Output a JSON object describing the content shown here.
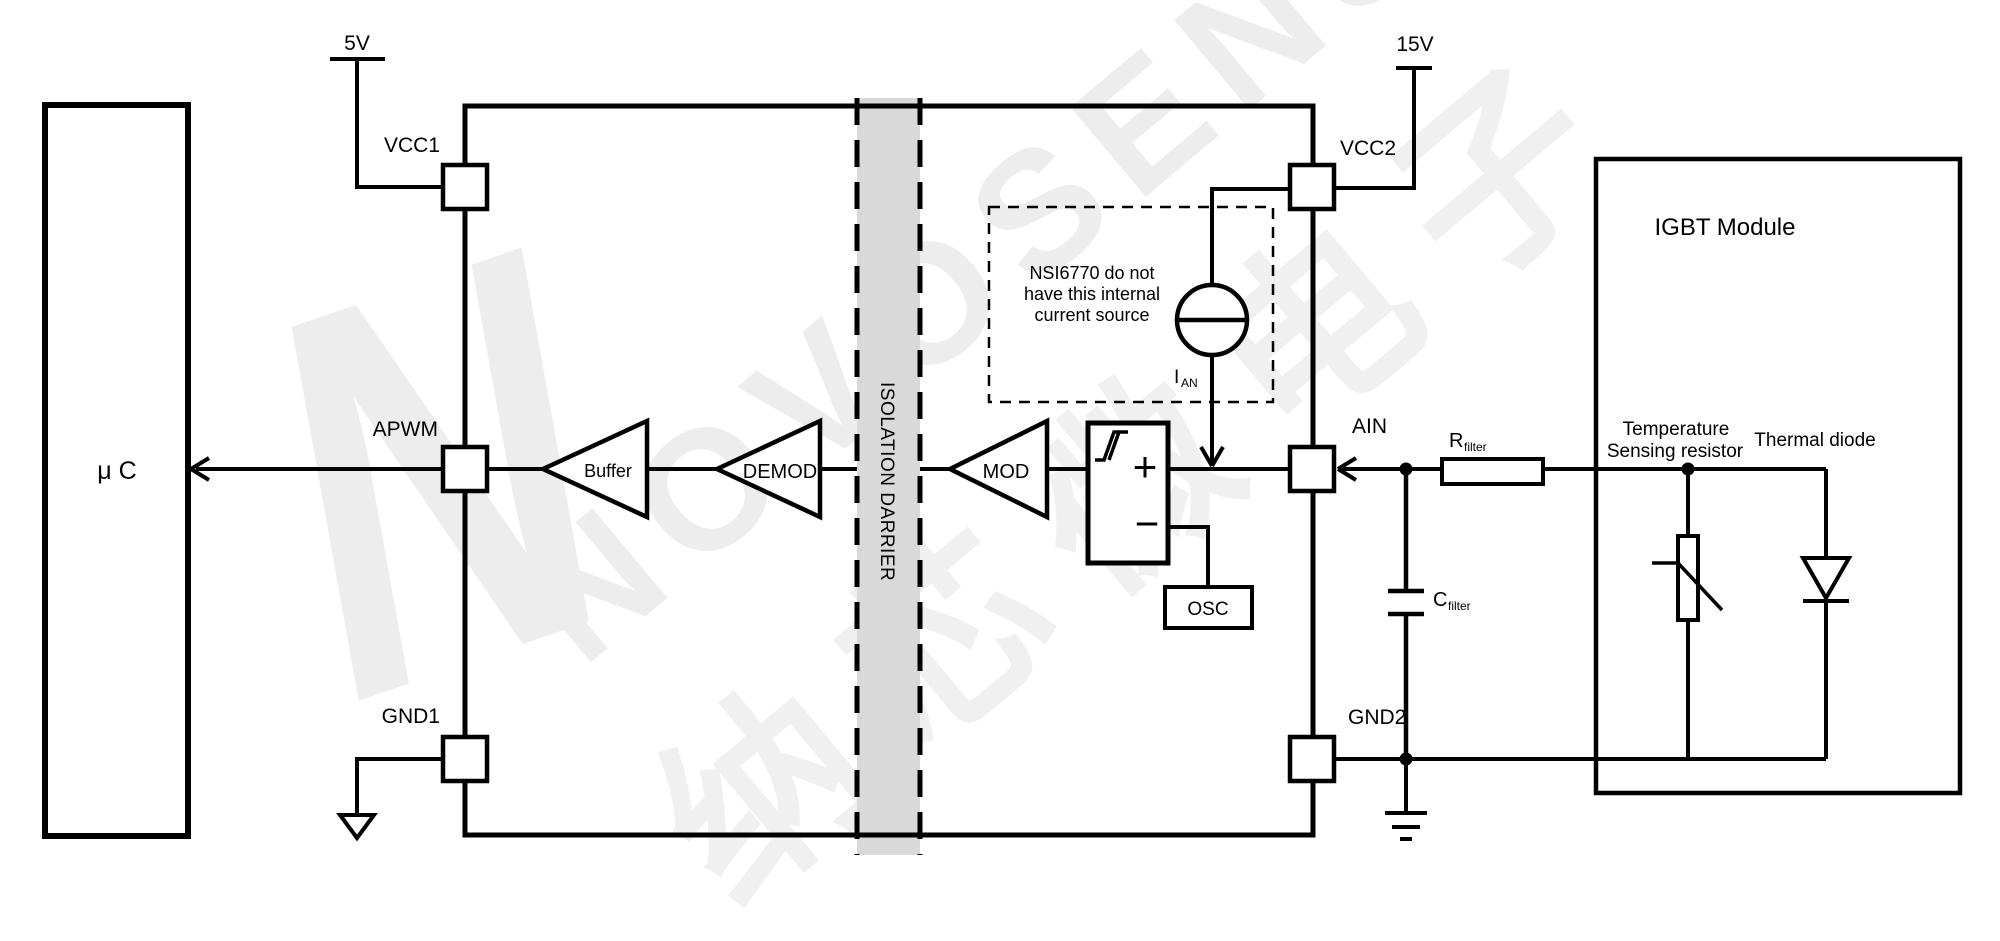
{
  "watermark": {
    "logo": "N",
    "latin": "NOVOSENSE",
    "cjk": "纳芯微电子"
  },
  "supplies": {
    "vcc1": "5V",
    "vcc2": "15V"
  },
  "microcontroller": {
    "label": "μ C"
  },
  "ic": {
    "pins": {
      "vcc1": "VCC1",
      "apwm": "APWM",
      "gnd1": "GND1",
      "vcc2": "VCC2",
      "ain": "AIN",
      "gnd2": "GND2"
    },
    "blocks": {
      "buffer": "Buffer",
      "demod": "DEMOD",
      "mod": "MOD",
      "osc": "OSC"
    },
    "comparator": {
      "plus": "+",
      "minus": "−"
    },
    "isolation_barrier": "ISOLATION DARRIER",
    "note": {
      "line1": "NSI6770 do not",
      "line2": "have this internal",
      "line3": "current source"
    },
    "current_source": {
      "symbol": "I",
      "subscript": "AN"
    }
  },
  "filter": {
    "r": "R",
    "r_sub": "filter",
    "c": "C",
    "c_sub": "filter"
  },
  "igbt_module": {
    "title": "IGBT Module",
    "thermistor_label1": "Temperature",
    "thermistor_label2": "Sensing resistor",
    "diode_label": "Thermal diode"
  },
  "colors": {
    "line": "#000000",
    "barrier_fill": "#d9d9d9",
    "watermark": "#ededed"
  }
}
